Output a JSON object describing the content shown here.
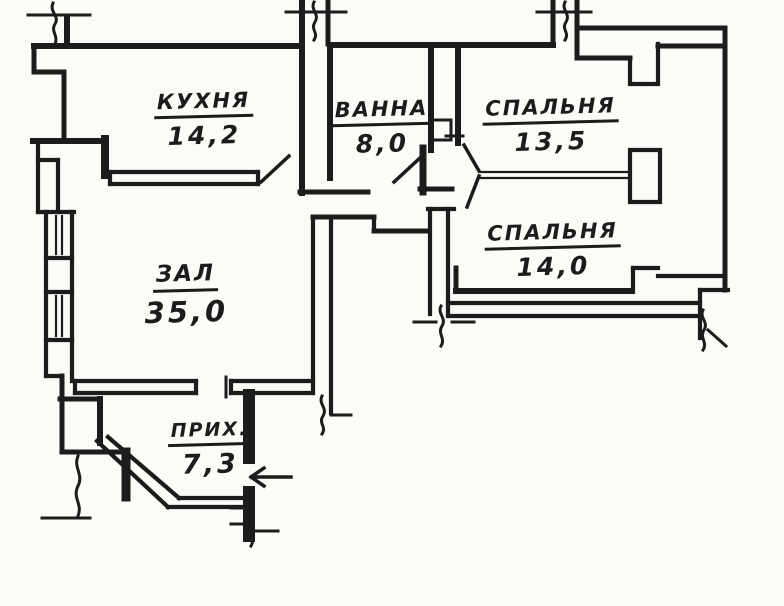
{
  "floor_plan": {
    "rooms": [
      {
        "name": "КУХНЯ",
        "area": "14,2"
      },
      {
        "name": "ВАННА",
        "area": "8,0"
      },
      {
        "name": "СПАЛЬНЯ",
        "area": "13,5"
      },
      {
        "name": "СПАЛЬНЯ",
        "area": "14,0"
      },
      {
        "name": "ЗАЛ",
        "area": "35,0"
      },
      {
        "name": "ПРИХ.",
        "area": "7,3"
      }
    ],
    "entrance_arrow_icon": "left-arrow"
  },
  "colors": {
    "ink": "#1c1c1c",
    "paper": "#fbfbf8"
  }
}
